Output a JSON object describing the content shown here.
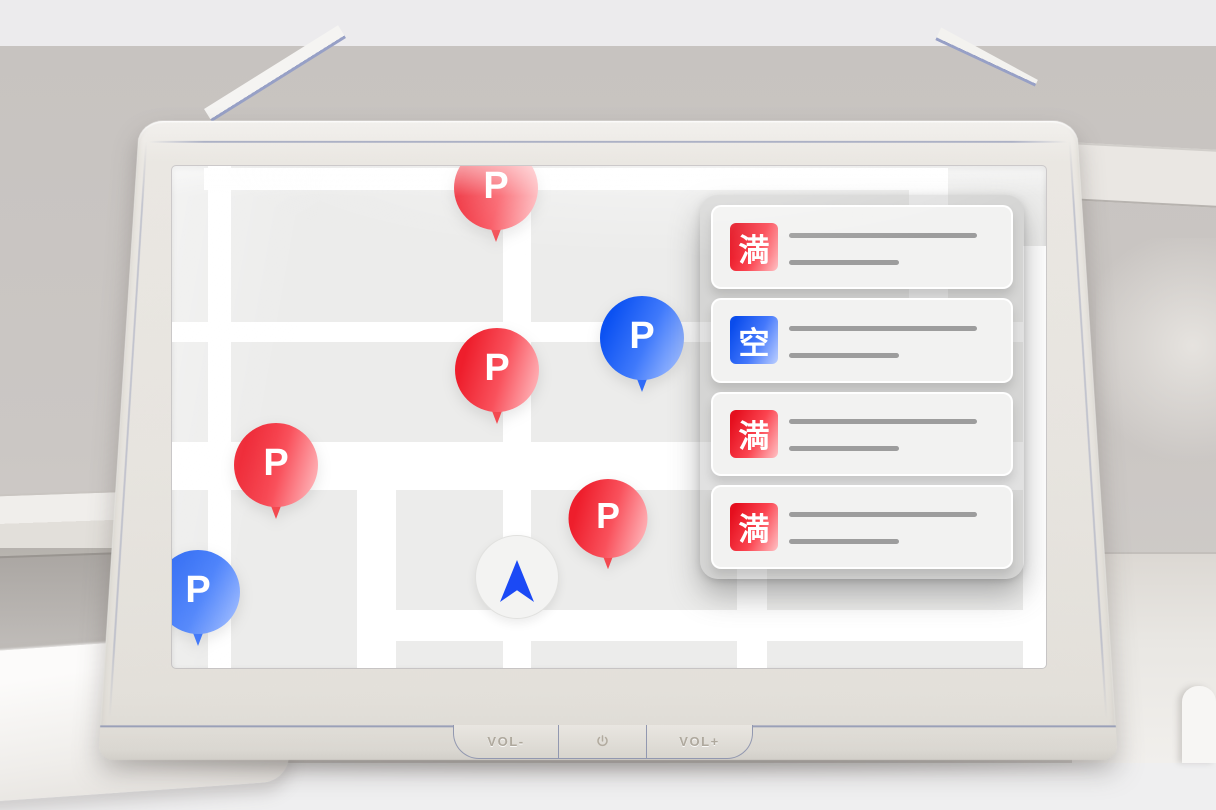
{
  "device": {
    "type_hint": "in-car navigation head unit",
    "volume_down_label": "VOL-",
    "volume_up_label": "VOL+",
    "power_icon": "power-icon"
  },
  "map": {
    "pins": [
      {
        "label": "P",
        "status": "full"
      },
      {
        "label": "P",
        "status": "vacant"
      },
      {
        "label": "P",
        "status": "full"
      },
      {
        "label": "P",
        "status": "full"
      },
      {
        "label": "P",
        "status": "full"
      },
      {
        "label": "P",
        "status": "vacant"
      }
    ],
    "current_location": {
      "icon": "navigation-arrow-icon"
    }
  },
  "panel": {
    "items": [
      {
        "status_label": "満",
        "status": "full"
      },
      {
        "status_label": "空",
        "status": "vacant"
      },
      {
        "status_label": "満",
        "status": "full"
      },
      {
        "status_label": "満",
        "status": "full"
      }
    ]
  },
  "colors": {
    "full_red": "#e8101c",
    "vacant_blue": "#0b50e8",
    "marker_blue": "#1b49f5",
    "map_bg": "#ececeb",
    "road_white": "#ffffff",
    "bezel": "#e7e4df"
  }
}
